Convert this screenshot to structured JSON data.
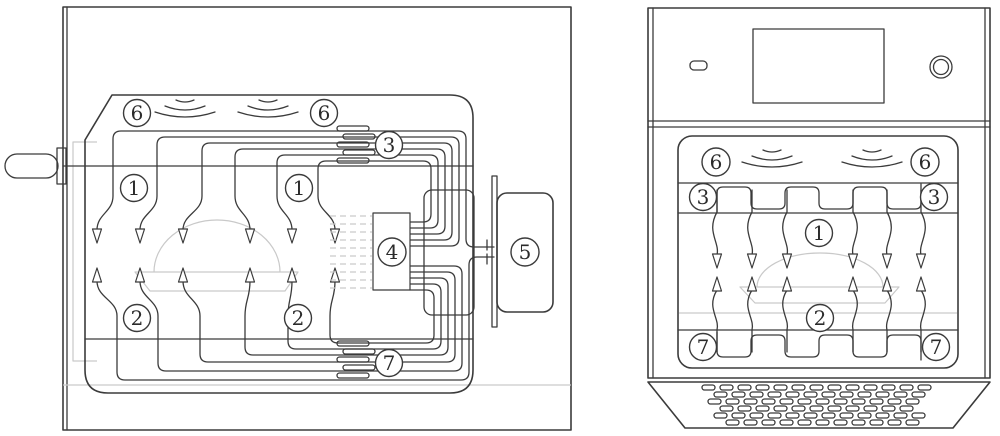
{
  "background": "#ffffff",
  "colors": {
    "line": "#3b3b3b",
    "light_line": "#c9c9c9",
    "text": "#2b2b2b"
  },
  "figures": {
    "left": {
      "view": "side-section-view",
      "callouts": {
        "c6a": "6",
        "c6b": "6",
        "c3": "3",
        "c1a": "1",
        "c1b": "1",
        "c4": "4",
        "c5": "5",
        "c2a": "2",
        "c2b": "2",
        "c7": "7"
      }
    },
    "right": {
      "view": "front-view",
      "callouts": {
        "c6a": "6",
        "c6b": "6",
        "c3a": "3",
        "c3b": "3",
        "c1": "1",
        "c2": "2",
        "c7a": "7",
        "c7b": "7"
      }
    }
  },
  "icons": {
    "wave_emitter": "steam-wave-icon",
    "heater_fins": "finned-heater-icon",
    "heater_coil": "serpentine-heater-icon",
    "vent_grille": "perforated-grille-icon",
    "knob": "rotary-knob-icon",
    "power_button": "power-button-icon",
    "display": "display-screen-icon"
  }
}
